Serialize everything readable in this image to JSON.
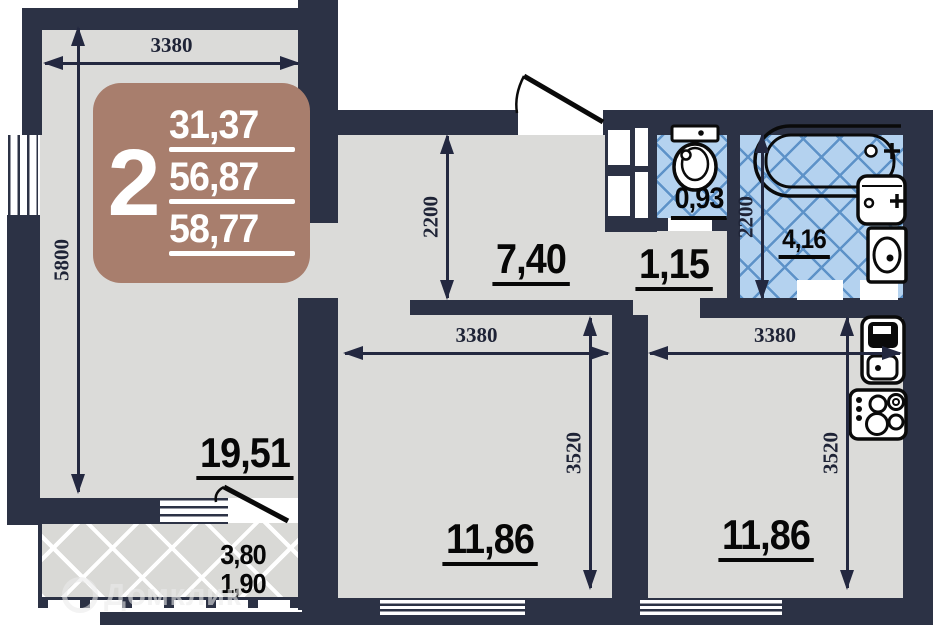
{
  "badge": {
    "room_count": "2",
    "living_area": "31,37",
    "area_mid": "56,87",
    "area_total": "58,77"
  },
  "areas": {
    "living": "19,51",
    "hallway": "7,40",
    "corridor": "1,15",
    "wc": "0,93",
    "bathroom": "4,16",
    "bedroom": "11,86",
    "kitchen_room": "11,86",
    "balcony_full": "3,80",
    "balcony_reduced": "1,90"
  },
  "dimensions": {
    "living_width": "3380",
    "living_depth": "5800",
    "hallway_depth": "2200",
    "bathroom_depth": "2200",
    "bedroom_width": "3380",
    "bedroom_depth": "3520",
    "kitchen_width": "3380",
    "kitchen_depth": "3520"
  },
  "watermark": "Домклик",
  "colors": {
    "wall": "#2c3245",
    "floor": "#dbdbd9",
    "tile_bg": "#b4d2ef",
    "tile_line": "#5d92c8",
    "badge_bg": "#a87e6d"
  }
}
